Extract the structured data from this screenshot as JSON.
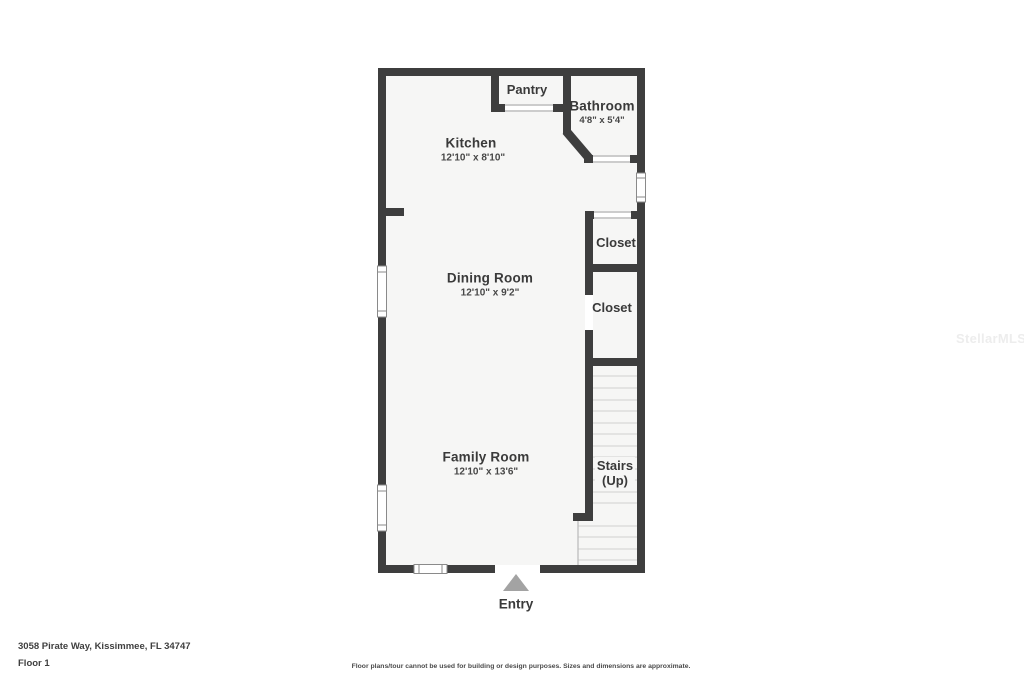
{
  "plan": {
    "rooms": {
      "pantry": {
        "name": "Pantry"
      },
      "bathroom": {
        "name": "Bathroom",
        "dims": "4'8\" x 5'4\""
      },
      "kitchen": {
        "name": "Kitchen",
        "dims": "12'10\" x 8'10\""
      },
      "closet_upper": {
        "name": "Closet"
      },
      "closet_lower": {
        "name": "Closet"
      },
      "dining_room": {
        "name": "Dining Room",
        "dims": "12'10\" x 9'2\""
      },
      "family_room": {
        "name": "Family Room",
        "dims": "12'10\" x 13'6\""
      },
      "stairs": {
        "name": "Stairs",
        "direction": "(Up)"
      },
      "entry": {
        "name": "Entry"
      }
    },
    "colors": {
      "wall": "#3e3e3e",
      "floor": "#f6f6f5",
      "stair_tread": "#d8d8d8",
      "entry_arrow": "#a3a3a3",
      "label_text": "#3a3a3a"
    }
  },
  "footer": {
    "address": "3058 Pirate Way, Kissimmee, FL 34747",
    "floor_label": "Floor 1",
    "disclaimer": "Floor plans/tour cannot be used for building or design purposes. Sizes and dimensions are approximate."
  },
  "watermark": "StellarMLS"
}
